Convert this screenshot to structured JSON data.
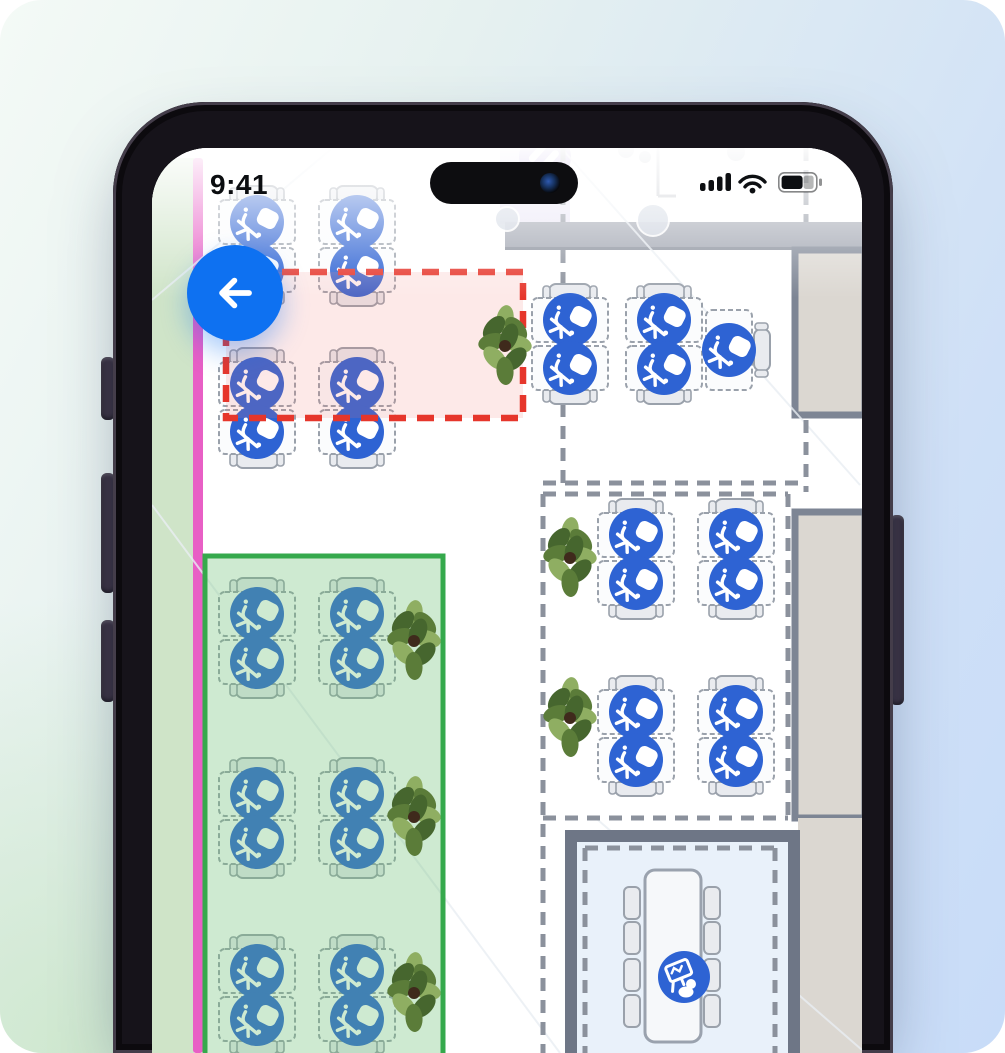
{
  "status_bar": {
    "time": "9:41",
    "icons": [
      "cellular-signal",
      "wifi",
      "battery"
    ]
  },
  "back_button": {
    "icon": "arrow-left"
  },
  "colors": {
    "accent": "#0e71f1",
    "desk_icon": "#2e63d3",
    "zone_green": "#35a94c",
    "zone_green_fill": "rgba(105,190,115,0.33)",
    "zone_red": "#e6362b",
    "zone_red_fill": "rgba(242,120,115,0.16)",
    "dash_gray": "#8b919c",
    "wall": "#7d8594",
    "wall_fill": "#dbd7d1",
    "band": "#9da2ae",
    "meeting_fill": "#e9f1fa",
    "meeting_wall": "#6e7686",
    "green_band": "#cfe4c8",
    "pink_stripe": "#e85fc5",
    "lavender": "#eae6f6",
    "purple_icon": "#b6a3e3",
    "desk_stroke": "#9aa1ab",
    "desk_fill": "#fbfcfd",
    "chair_fill": "#e9ebef",
    "table_fill": "#f6f8fa",
    "plant_core": "#3f2a1c",
    "plant_dark": "#46662e",
    "plant_mid": "#5b7c39",
    "plant_light": "#8fae62",
    "diag": "#e9edf2",
    "fixture": "#c9cdd4"
  },
  "floorplan": {
    "plan_rect": [
      152,
      148,
      710,
      905
    ],
    "left_band": {
      "green": [
        152,
        158,
        42,
        895
      ],
      "pink": [
        193,
        158,
        10,
        895
      ]
    },
    "top_rooms": {
      "lavender": [
        500,
        148,
        70,
        76
      ],
      "divider_lines": [
        "M658 148 V196",
        "M658 196 H676"
      ],
      "sink_circles": [
        [
          626,
          150,
          8
        ],
        [
          645,
          157,
          6
        ],
        [
          736,
          152,
          9
        ]
      ],
      "purple_marker": [
        545,
        157,
        26
      ],
      "wall_band": [
        505,
        222,
        357,
        28
      ],
      "door_circles": [
        [
          653,
          220,
          16
        ],
        [
          507,
          219,
          12
        ]
      ]
    },
    "side_rooms": [
      [
        795,
        250,
        70,
        165
      ],
      [
        795,
        512,
        70,
        306
      ]
    ],
    "beige_area": [
      798,
      818,
      64,
      235
    ],
    "diagonals": [
      "M152 505 L560 1053",
      "M563 150 L860 485",
      "M598 820 L862 1050",
      "M152 300 L330 150"
    ],
    "gray_dashes": [
      "M563 148 V222",
      "M563 250 V483",
      "M806 148 V222",
      "M806 420 V492",
      "M543 483 H806",
      "M543 494 H788",
      "M543 494 V1053",
      "M788 494 V818",
      "M543 818 H788"
    ],
    "desk_size": [
      76,
      44
    ],
    "desk_pairs": [
      [
        257,
        246
      ],
      [
        357,
        246
      ],
      [
        257,
        408
      ],
      [
        357,
        408
      ],
      [
        570,
        344
      ],
      [
        664,
        344
      ],
      [
        636,
        559
      ],
      [
        736,
        559
      ],
      [
        636,
        736
      ],
      [
        736,
        736
      ],
      [
        257,
        638
      ],
      [
        357,
        638
      ],
      [
        257,
        818
      ],
      [
        357,
        818
      ],
      [
        257,
        995
      ],
      [
        357,
        995
      ]
    ],
    "single_desk": {
      "rect": [
        706,
        310,
        46,
        80
      ],
      "icon": [
        729,
        350
      ],
      "chair": [
        762,
        350
      ]
    },
    "plants": [
      [
        505,
        346,
        1.0
      ],
      [
        570,
        558,
        1.0
      ],
      [
        570,
        718,
        1.0
      ],
      [
        414,
        641,
        1.0
      ],
      [
        414,
        817,
        1.0
      ],
      [
        414,
        993,
        1.0
      ]
    ],
    "zones": {
      "red": {
        "rect": [
          226,
          272,
          297,
          146
        ]
      },
      "green": {
        "rect": [
          205,
          556,
          238,
          500
        ]
      }
    },
    "meeting_room": {
      "floor": [
        577,
        842,
        211,
        211
      ],
      "walls": [
        [
          565,
          830,
          12,
          223
        ],
        [
          565,
          830,
          235,
          12
        ],
        [
          788,
          830,
          12,
          223
        ]
      ],
      "inner_dashes": [
        "M585 848 H775",
        "M775 848 V1053",
        "M585 848 V1053"
      ],
      "table": [
        645,
        870,
        56,
        172
      ],
      "chair_ys": [
        903,
        938,
        975,
        1011
      ],
      "chair_xs": [
        624,
        704
      ],
      "marker": [
        684,
        977
      ]
    }
  }
}
